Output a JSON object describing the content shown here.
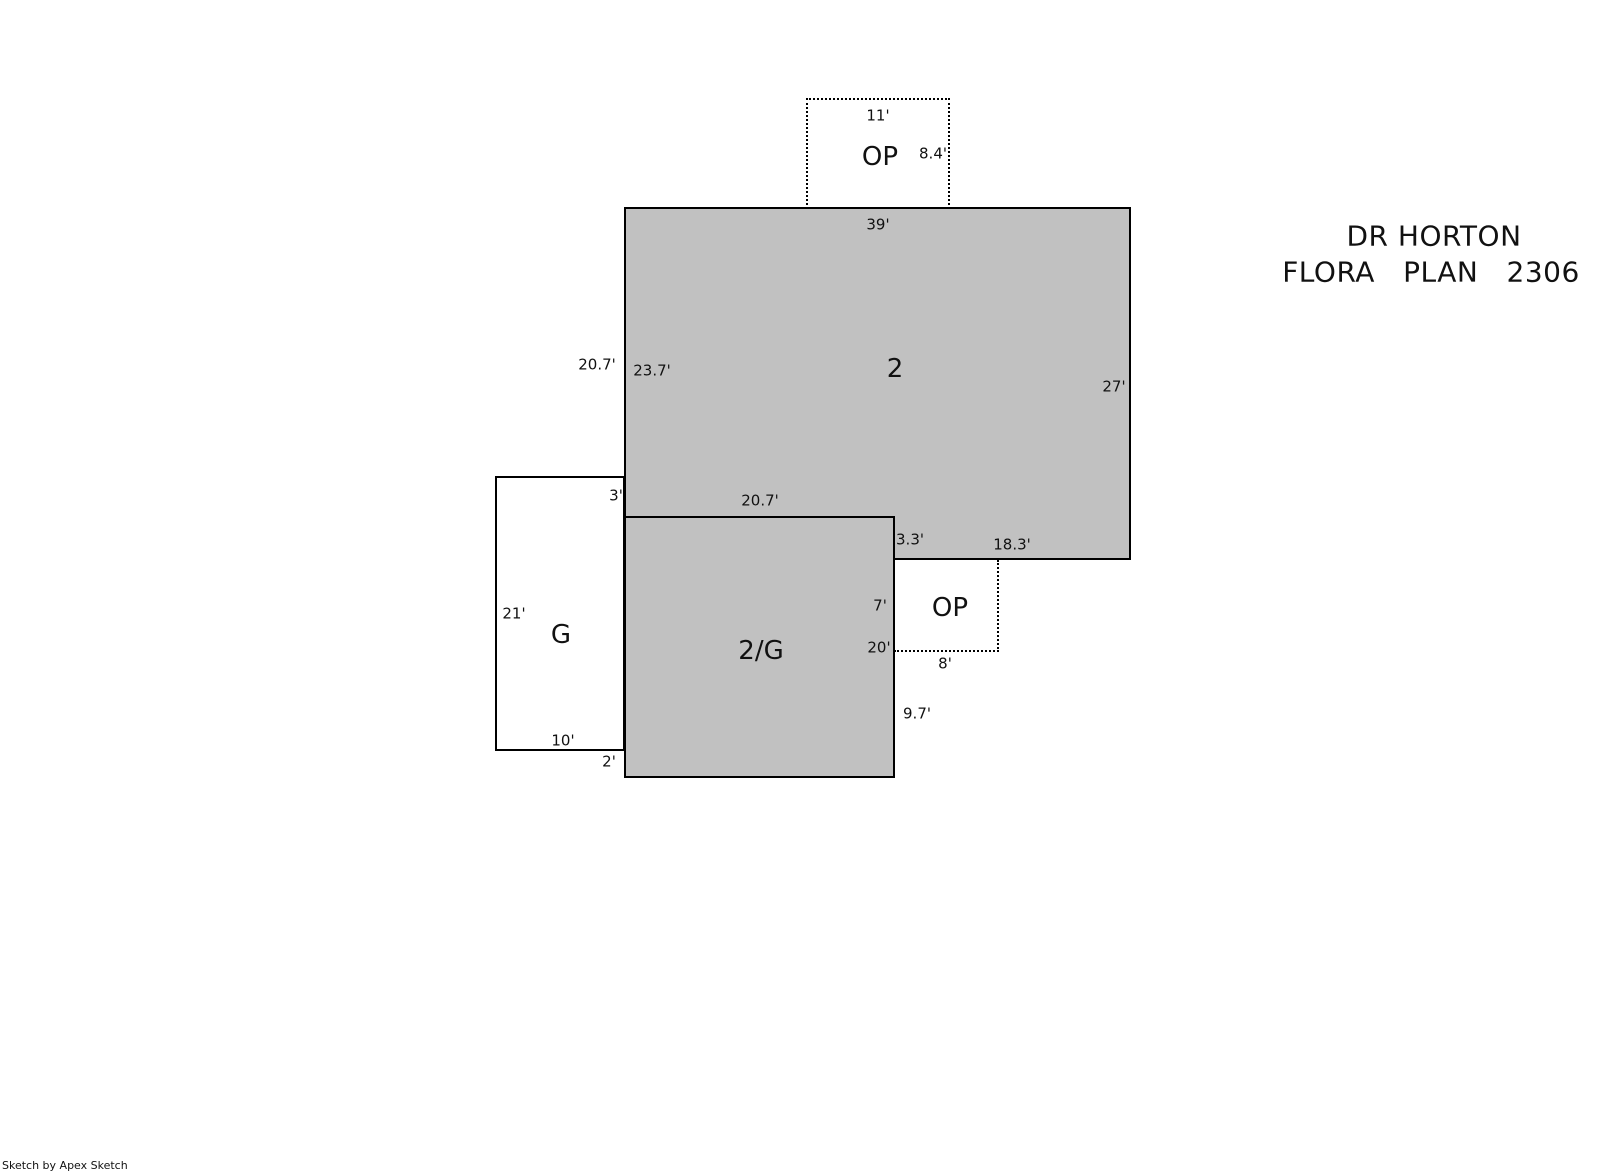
{
  "title": {
    "line1": "DR HORTON",
    "line2": "FLORA   PLAN   2306"
  },
  "watermark": "Sketch by Apex Sketch",
  "colors": {
    "area_fill": "#c1c1c1",
    "line_color": "#000000",
    "background": "#ffffff"
  },
  "areas": {
    "second_floor": {
      "label": "2",
      "dims": {
        "top": "39'",
        "left_exterior": "20.7'",
        "left_interior": "23.7'",
        "right": "27'",
        "bottom": "18.3'"
      }
    },
    "second_floor_garage": {
      "label": "2/G",
      "dims": {
        "top": "20.7'",
        "right_step": "3.3'",
        "right_upper": "7'",
        "right_mid": "20'",
        "right_lower": "9.7'"
      }
    },
    "garage": {
      "label": "G",
      "dims": {
        "left": "21'",
        "bottom": "10'",
        "top_offset": "3'",
        "bottom_offset": "2'"
      }
    },
    "open_porch_top": {
      "label": "OP",
      "dims": {
        "top": "11'",
        "right": "8.4'"
      }
    },
    "open_porch_side": {
      "label": "OP",
      "dims": {
        "bottom": "8'"
      }
    }
  }
}
